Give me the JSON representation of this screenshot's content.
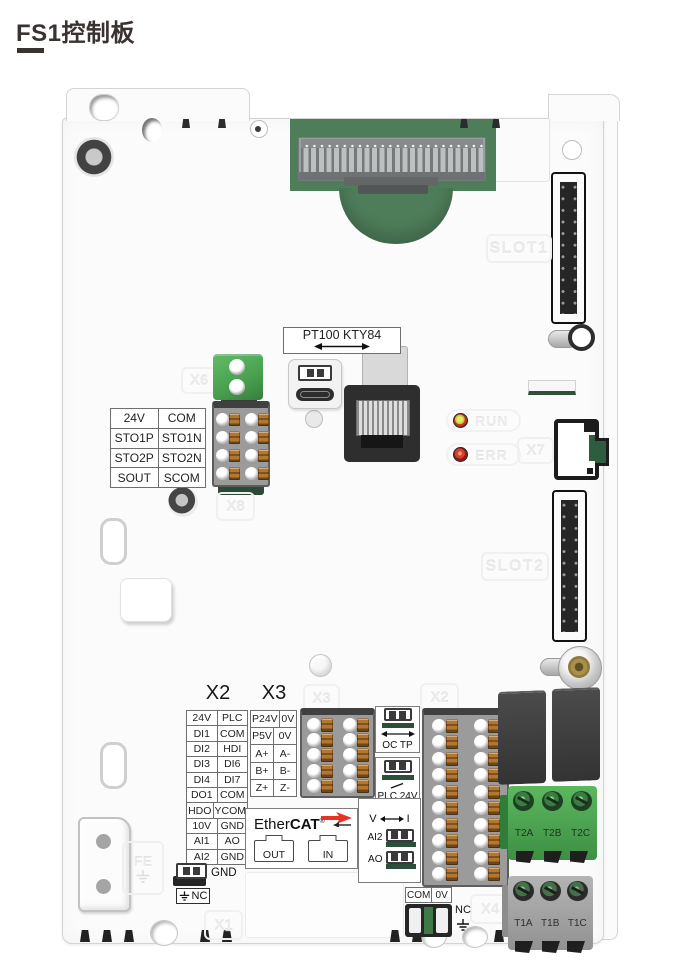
{
  "page": {
    "title": "FS1控制板"
  },
  "board": {
    "embossed": {
      "slot1": "SLOT1",
      "slot2": "SLOT2",
      "x1": "X1",
      "x2": "X2",
      "x3": "X3",
      "x4": "X4",
      "x6": "X6",
      "x7": "X7",
      "x8": "X8",
      "fe": "FE",
      "run": "RUN",
      "err": "ERR"
    },
    "sensor_select_label": "PT100 KTY84",
    "sto_table": {
      "rows": [
        [
          "24V",
          "COM"
        ],
        [
          "STO1P",
          "STO1N"
        ],
        [
          "STO2P",
          "STO2N"
        ],
        [
          "SOUT",
          "SCOM"
        ]
      ]
    },
    "io_section": {
      "x2_header": "X2",
      "x3_header": "X3",
      "x2_table": {
        "rows": [
          [
            "24V",
            "PLC"
          ],
          [
            "DI1",
            "COM"
          ],
          [
            "DI2",
            "HDI"
          ],
          [
            "DI3",
            "DI6"
          ],
          [
            "DI4",
            "DI7"
          ],
          [
            "DO1",
            "COM"
          ],
          [
            "HDO",
            "YCOM"
          ],
          [
            "10V",
            "GND"
          ],
          [
            "AI1",
            "AO"
          ],
          [
            "AI2",
            "GND"
          ]
        ]
      },
      "x3_table": {
        "rows": [
          [
            "P24V",
            "0V"
          ],
          [
            "P5V",
            "0V"
          ],
          [
            "A+",
            "A-"
          ],
          [
            "B+",
            "B-"
          ],
          [
            "Z+",
            "Z-"
          ]
        ]
      }
    },
    "ethercat": {
      "brand_light": "Ether",
      "brand_bold": "CAT",
      "reg": "®",
      "out_label": "OUT",
      "in_label": "IN"
    },
    "switches": {
      "oc_tp": "OC TP",
      "plc_24v": "PLC 24V",
      "v": "V",
      "i": "I",
      "ai2": "AI2",
      "ao": "AO",
      "gnd": "GND",
      "nc": "NC"
    },
    "bottom": {
      "com_0v": [
        "COM",
        "0V"
      ],
      "nc": "NC"
    },
    "relay_terminals": {
      "t2": [
        "T2A",
        "T2B",
        "T2C"
      ],
      "t1": [
        "T1A",
        "T1B",
        "T1C"
      ]
    },
    "colors": {
      "pcb_green": "#4e7d5a",
      "terminal_green": "#4aa251",
      "clamp_orange": "#b5762e",
      "led_red": "#c43428",
      "led_yellow": "#d8d84a",
      "ethercat_red": "#e63323"
    }
  }
}
